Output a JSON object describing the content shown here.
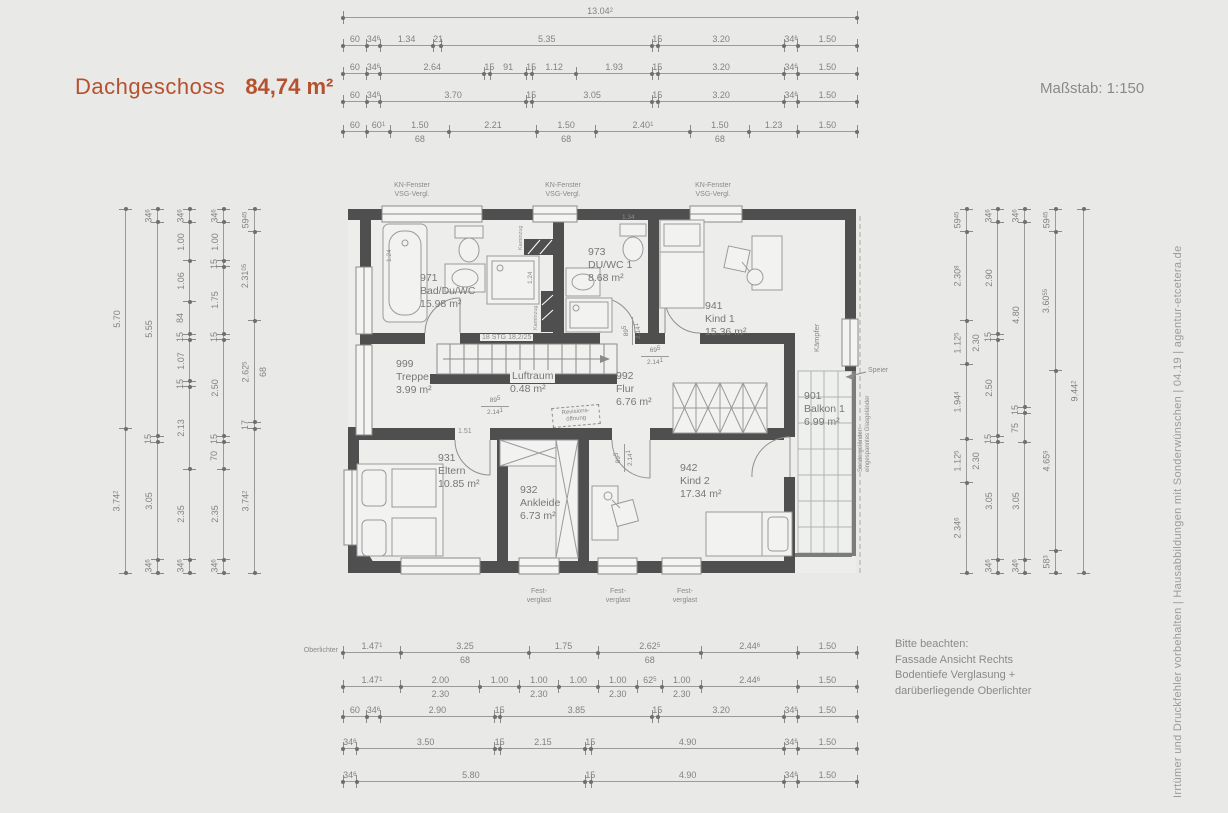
{
  "header": {
    "title": "Dachgeschoss",
    "area": "84,74 m²",
    "scale_label": "Maßstab: 1:150"
  },
  "side_note": "Irrtümer und Druckfehler vorbehalten  |  Hausabbildungen mit Sonderwünschen  |  04.19  |  agentur-etcetera.de",
  "notice": {
    "lines": [
      "Bitte beachten:",
      "Fassade Ansicht Rechts",
      "Bodentiefe Verglasung +",
      "darüberliegende Oberlichter"
    ]
  },
  "window_annotations": {
    "kn_fenster": {
      "line1": "KN-Fenster",
      "line2": "VSG-Vergl."
    },
    "fest_verglast": {
      "line1": "Fest-",
      "line2": "verglast"
    },
    "oberlichter": "Oberlichter"
  },
  "rooms": [
    {
      "number": "971",
      "name": "Bad/Du/WC",
      "area": "15.98 m²"
    },
    {
      "number": "973",
      "name": "DU/WC 1",
      "area": "8.68 m²"
    },
    {
      "number": "941",
      "name": "Kind 1",
      "area": "15.36 m²"
    },
    {
      "number": "999",
      "name": "Treppe",
      "area": "3.99 m²"
    },
    {
      "number": "",
      "name": "Luftraum",
      "area": "0.48 m²"
    },
    {
      "number": "992",
      "name": "Flur",
      "area": "6.76 m²"
    },
    {
      "number": "901",
      "name": "Balkon 1",
      "area": "6.99 m²"
    },
    {
      "number": "931",
      "name": "Eltern",
      "area": "10.85 m²"
    },
    {
      "number": "932",
      "name": "Ankleide",
      "area": "6.73 m²"
    },
    {
      "number": "942",
      "name": "Kind 2",
      "area": "17.34 m²"
    }
  ],
  "plan_labels": {
    "stairs": "18 STG 18,2/25",
    "revision": {
      "line1": "Revisions-",
      "line2": "öffnung"
    },
    "kaempfer": "Kämpfer",
    "speier": "Speier",
    "railing": {
      "line1": "Sondergeländer:",
      "line2": "eingespanntes Glasgeländer"
    },
    "shaft1": "Kaminzug",
    "shaft2": "Kaminzug",
    "dim_1_51": "1.51",
    "dim_1_24a": "1.24",
    "dim_1_24b": "1.24",
    "dim_1_34": "1.34"
  },
  "door_dims": [
    {
      "w": "89⁵",
      "h": "2.14¹"
    },
    {
      "w": "89⁵",
      "h": "2.14¹"
    },
    {
      "w": "69⁵",
      "h": "2.14¹"
    },
    {
      "w": "89⁵",
      "h": "2.14¹"
    }
  ],
  "dim_chains": {
    "top": [
      {
        "segments": [
          {
            "l": "13.04²"
          }
        ]
      },
      {
        "segments": [
          {
            "l": "60"
          },
          {
            "l": "34⁶"
          },
          {
            "l": "1.34"
          },
          {
            "l": "21"
          },
          {
            "l": "5.35"
          },
          {
            "l": "15"
          },
          {
            "l": "3.20"
          },
          {
            "l": "34⁶"
          },
          {
            "l": "1.50"
          }
        ]
      },
      {
        "segments": [
          {
            "l": "60"
          },
          {
            "l": "34⁶"
          },
          {
            "l": "2.64"
          },
          {
            "l": "15"
          },
          {
            "l": "91"
          },
          {
            "l": "15"
          },
          {
            "l": "1.12"
          },
          {
            "l": "1.93"
          },
          {
            "l": "15"
          },
          {
            "l": "3.20"
          },
          {
            "l": "34⁶"
          },
          {
            "l": "1.50"
          }
        ]
      },
      {
        "segments": [
          {
            "l": "60"
          },
          {
            "l": "34⁶"
          },
          {
            "l": "3.70"
          },
          {
            "l": "15"
          },
          {
            "l": "3.05"
          },
          {
            "l": "15"
          },
          {
            "l": "3.20"
          },
          {
            "l": "34⁶"
          },
          {
            "l": "1.50"
          }
        ]
      },
      {
        "segments": [
          {
            "l": "60"
          },
          {
            "l": "60¹"
          },
          {
            "l": "1.50",
            "sub": "68"
          },
          {
            "l": "2.21"
          },
          {
            "l": "1.50",
            "sub": "68"
          },
          {
            "l": "2.40¹"
          },
          {
            "l": "1.50",
            "sub": "68"
          },
          {
            "l": "1.23"
          },
          {
            "l": "1.50"
          }
        ]
      }
    ],
    "bottom": [
      {
        "segments": [
          {
            "l": "1.47¹"
          },
          {
            "l": "3.25",
            "sub": "68"
          },
          {
            "l": "1.75"
          },
          {
            "l": "2.62⁵",
            "sub": "68"
          },
          {
            "l": "2.44⁶"
          },
          {
            "l": "1.50"
          }
        ]
      },
      {
        "segments": [
          {
            "l": "1.47¹"
          },
          {
            "l": "2.00",
            "sub": "2.30"
          },
          {
            "l": "1.00"
          },
          {
            "l": "1.00",
            "sub": "2.30"
          },
          {
            "l": "1.00"
          },
          {
            "l": "1.00",
            "sub": "2.30"
          },
          {
            "l": "62⁵"
          },
          {
            "l": "1.00",
            "sub": "2.30"
          },
          {
            "l": "2.44⁶"
          },
          {
            "l": "1.50"
          }
        ]
      },
      {
        "segments": [
          {
            "l": "60"
          },
          {
            "l": "34⁶"
          },
          {
            "l": "2.90"
          },
          {
            "l": "15"
          },
          {
            "l": "3.85"
          },
          {
            "l": "15"
          },
          {
            "l": "3.20"
          },
          {
            "l": "34⁶"
          },
          {
            "l": "1.50"
          }
        ]
      },
      {
        "segments": [
          {
            "l": "34⁶"
          },
          {
            "l": "3.50"
          },
          {
            "l": "15"
          },
          {
            "l": "2.15"
          },
          {
            "l": "15"
          },
          {
            "l": "4.90"
          },
          {
            "l": "34⁶"
          },
          {
            "l": "1.50"
          }
        ]
      },
      {
        "segments": [
          {
            "l": "34⁶"
          },
          {
            "l": "5.80"
          },
          {
            "l": "15"
          },
          {
            "l": "4.90"
          },
          {
            "l": "34⁶"
          },
          {
            "l": "1.50"
          }
        ]
      }
    ],
    "left": [
      {
        "segments": [
          {
            "l": "5.70"
          },
          {
            "l": "3.74²"
          }
        ]
      },
      {
        "segments": [
          {
            "l": "34⁶"
          },
          {
            "l": "5.55"
          },
          {
            "l": "15"
          },
          {
            "l": "3.05"
          },
          {
            "l": "34⁶"
          }
        ]
      },
      {
        "segments": [
          {
            "l": "34⁶"
          },
          {
            "l": "1.00"
          },
          {
            "l": "1.06"
          },
          {
            "l": "84"
          },
          {
            "l": "15"
          },
          {
            "l": "1.07"
          },
          {
            "l": "15"
          },
          {
            "l": "2.13"
          },
          {
            "l": "2.35"
          },
          {
            "l": "34⁶"
          }
        ]
      },
      {
        "segments": [
          {
            "l": "34⁶"
          },
          {
            "l": "1.00"
          },
          {
            "l": "15"
          },
          {
            "l": "1.75"
          },
          {
            "l": "15"
          },
          {
            "l": "2.50"
          },
          {
            "l": "15"
          },
          {
            "l": "70"
          },
          {
            "l": "2.35"
          },
          {
            "l": "34⁶"
          }
        ]
      },
      {
        "segments": [
          {
            "l": "59⁴⁵"
          },
          {
            "l": "2.31⁰⁵"
          },
          {
            "l": "2.62⁵",
            "sub": "68"
          },
          {
            "l": "17"
          },
          {
            "l": "3.74²"
          }
        ]
      }
    ],
    "right": [
      {
        "segments": [
          {
            "l": "59⁴⁵"
          },
          {
            "l": "2.30⁸"
          },
          {
            "l": "1.12⁵",
            "sub": "2.30"
          },
          {
            "l": "1.94⁴"
          },
          {
            "l": "1.12⁵",
            "sub": "2.30"
          },
          {
            "l": "2.34⁶"
          }
        ]
      },
      {
        "segments": [
          {
            "l": "34⁶"
          },
          {
            "l": "2.90"
          },
          {
            "l": "15"
          },
          {
            "l": "2.50"
          },
          {
            "l": "15"
          },
          {
            "l": "3.05"
          },
          {
            "l": "34⁶"
          }
        ]
      },
      {
        "segments": [
          {
            "l": "34⁶"
          },
          {
            "l": "4.80"
          },
          {
            "l": "15"
          },
          {
            "l": "75"
          },
          {
            "l": "3.05"
          },
          {
            "l": "34⁶"
          }
        ]
      },
      {
        "segments": [
          {
            "l": "59⁴⁵"
          },
          {
            "l": "3.60⁵⁵"
          },
          {
            "l": "4.65⁹"
          },
          {
            "l": "58³"
          }
        ]
      },
      {
        "segments": [
          {
            "l": "9.44²"
          }
        ]
      }
    ]
  }
}
